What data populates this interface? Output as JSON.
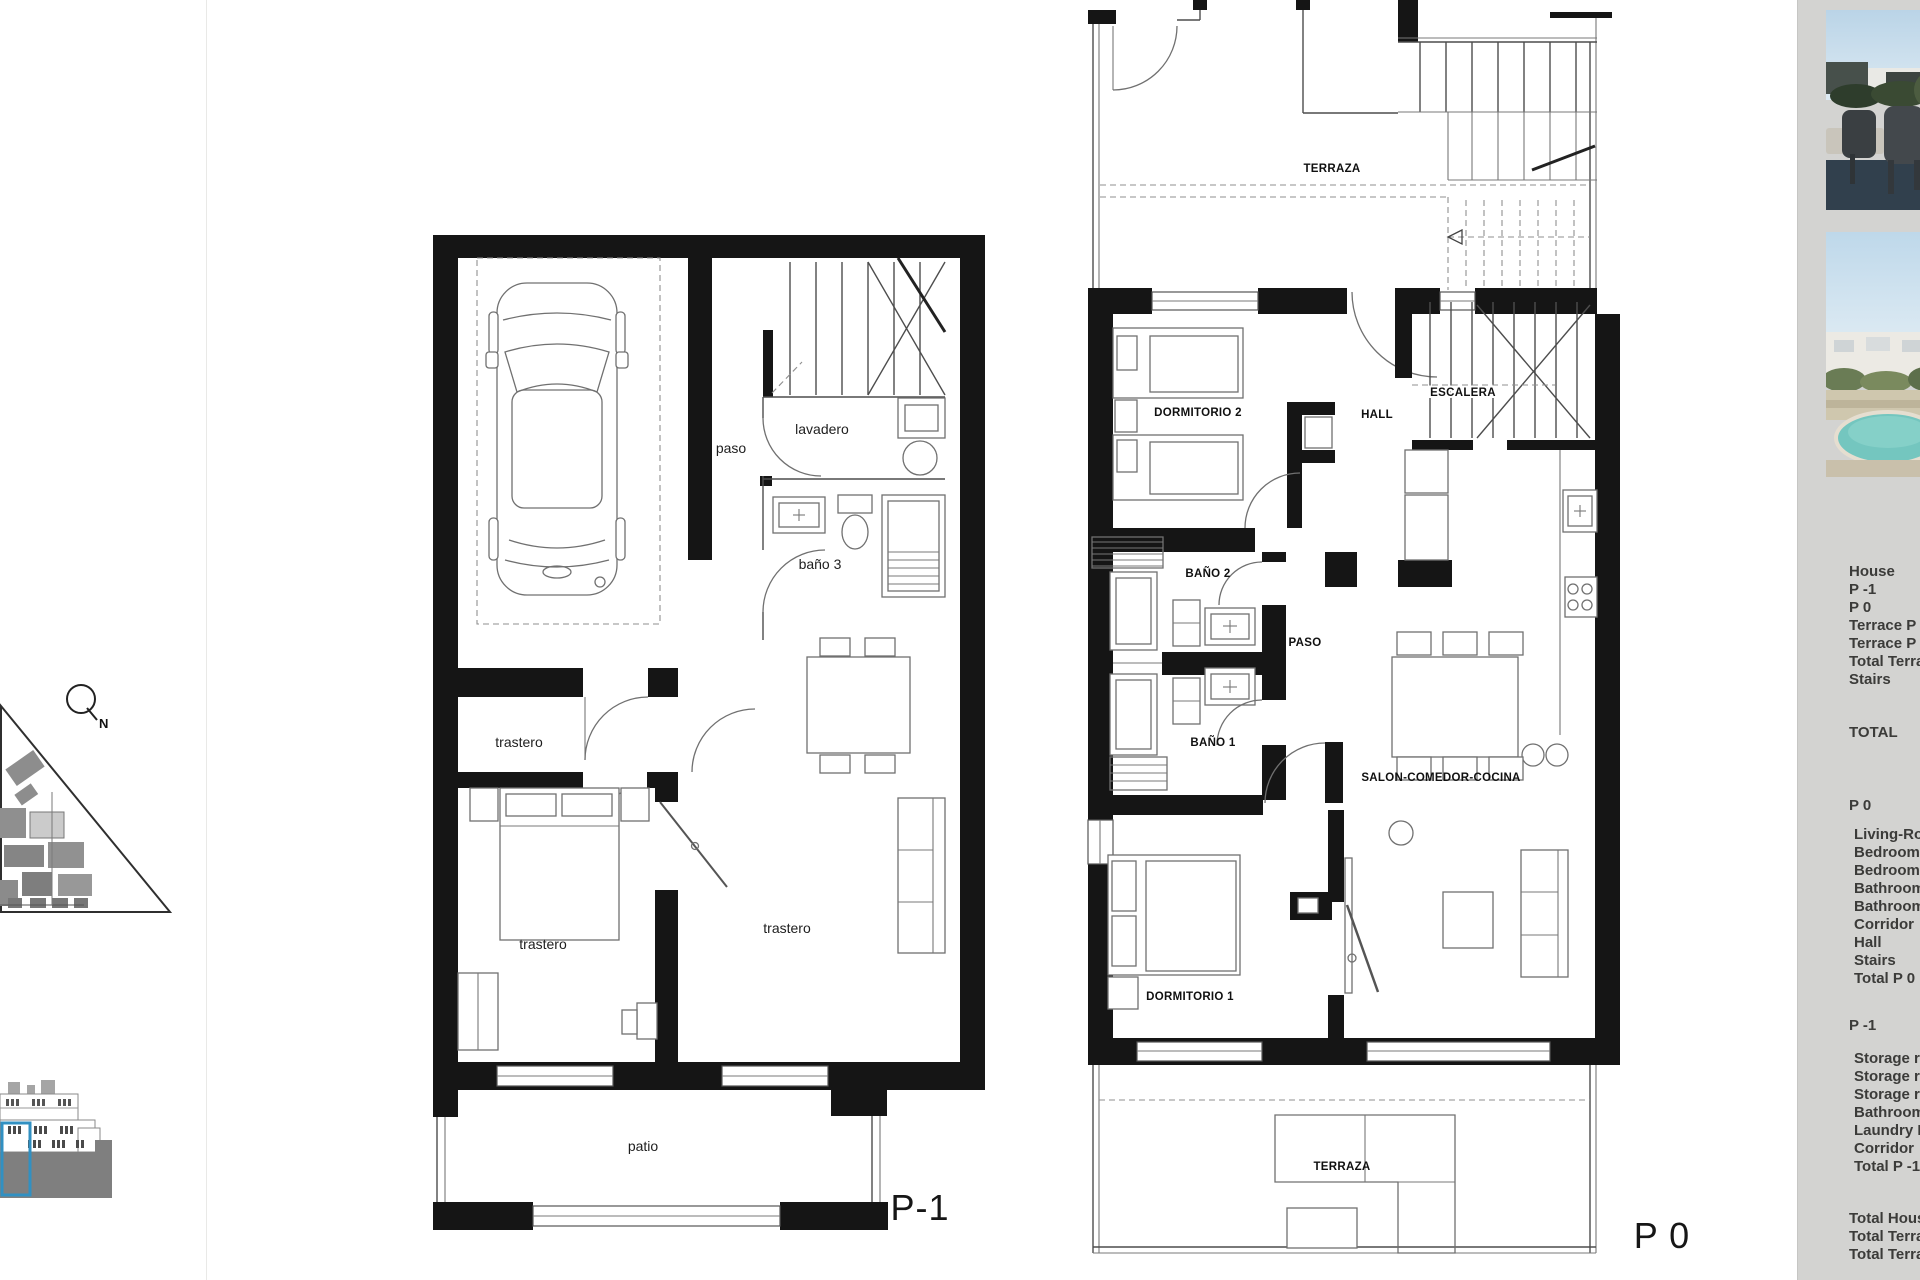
{
  "document": {
    "type": "floor-plan-sheet"
  },
  "colors": {
    "sidebar_bg": "#d3d3d1",
    "highlight_blue": "#3190c2",
    "pool": "#74c6bf"
  },
  "site": {
    "north_label": "N"
  },
  "plans": {
    "p1": {
      "floor_label": "P-1",
      "labels": {
        "paso": "paso",
        "lavadero": "lavadero",
        "bano3": "baño 3",
        "trastero_a": "trastero",
        "trastero_b": "trastero",
        "trastero_c": "trastero",
        "patio": "patio"
      }
    },
    "p0": {
      "floor_label": "P 0",
      "labels": {
        "terraza_roof": "TERRAZA",
        "dormitorio2": "DORMITORIO 2",
        "hall": "HALL",
        "escalera": "ESCALERA",
        "bano2": "BAÑO 2",
        "paso": "PASO",
        "bano1": "BAÑO 1",
        "salon": "SALON-COMEDOR-COCINA",
        "dormitorio1": "DORMITORIO 1",
        "terraza": "TERRAZA"
      }
    }
  },
  "sidebar": {
    "lines": [
      "House",
      "P -1",
      "P 0",
      "Terrace P -1",
      "Terrace P 0",
      "Total Terraces",
      "Stairs",
      "TOTAL",
      "P 0",
      "Living-Room",
      "Bedroom 1",
      "Bedroom 2",
      "Bathroom 1",
      "Bathroom 2",
      "Corridor",
      "Hall",
      "Stairs",
      "Total P 0",
      "P -1",
      "Storage room",
      "Storage room",
      "Storage room",
      "Bathroom 3",
      "Laundry Room",
      "Corridor",
      "Total P -1",
      "Total House",
      "Total Terraces",
      "Total Terraces"
    ]
  }
}
